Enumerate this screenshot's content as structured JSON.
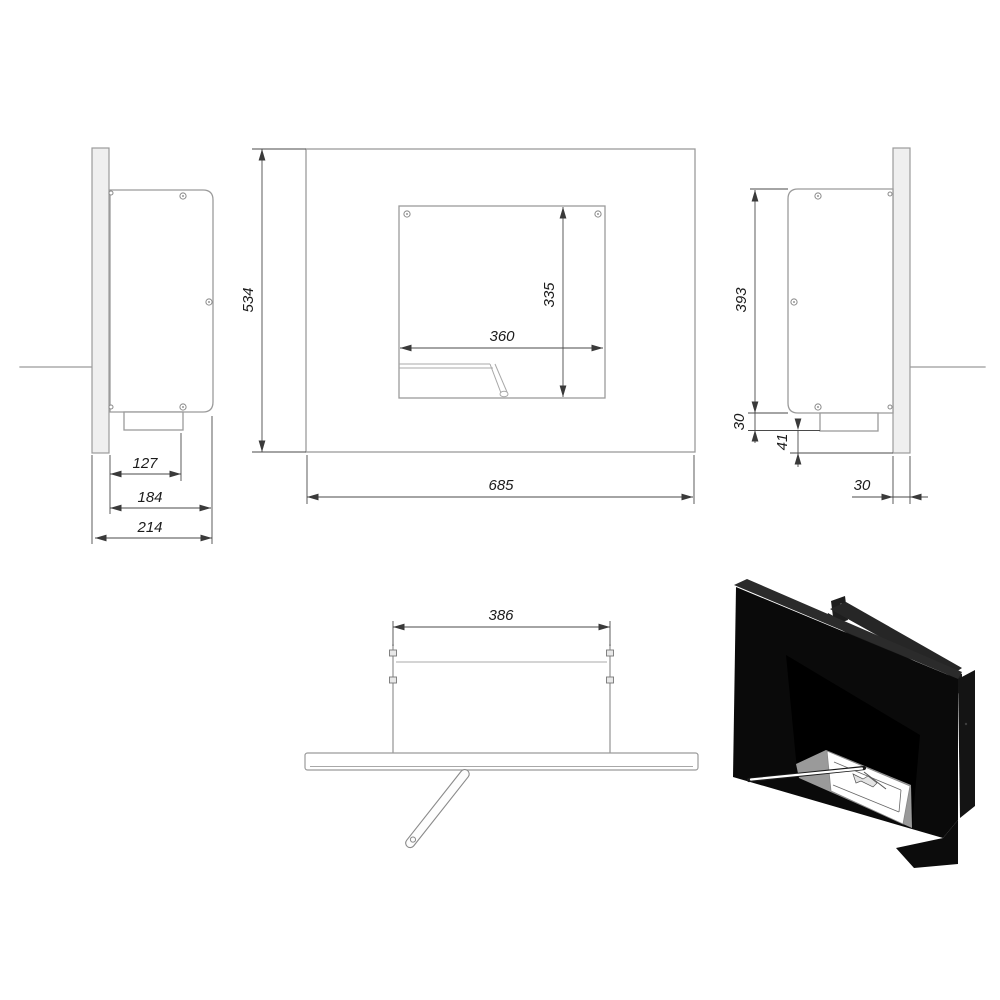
{
  "drawing": {
    "subject": "wall-mounted-bioethanol-fireplace-technical-drawing",
    "units_implied": "mm"
  },
  "dims": {
    "side_left": {
      "inner_depth": "127",
      "body_depth": "184",
      "total_depth": "214"
    },
    "front": {
      "overall_height": "534",
      "overall_width": "685",
      "opening_width": "360",
      "opening_height": "335"
    },
    "side_right": {
      "body_height": "393",
      "tray_height": "30",
      "bottom_offset": "41",
      "panel_thickness": "30"
    },
    "top": {
      "bracket_spacing": "386"
    }
  },
  "colors": {
    "outline_gray": "#9b9b9b",
    "dimension_gray": "#4a4a4a",
    "text_black": "#1b1b1b",
    "render_black": "#0a0a0a",
    "render_sill_gray": "#9a9a9a",
    "background": "#ffffff"
  }
}
